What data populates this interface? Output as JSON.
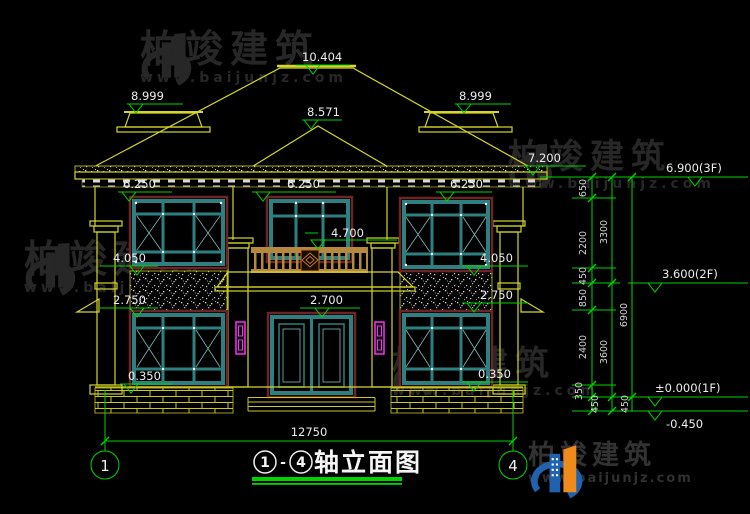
{
  "title_block": {
    "axis_from": "1",
    "separator": "-",
    "axis_to": "4",
    "name": "轴立面图"
  },
  "axis_bubbles": {
    "left": "1",
    "right": "4"
  },
  "overall_dim": "12750",
  "markers": {
    "ridge": "10.404",
    "left_wing": "8.999",
    "right_wing": "8.999",
    "porch_ridge": "8.571",
    "eave": "7.200",
    "f3": "6.900(3F)",
    "eave_l": "6.250",
    "eave_c": "6.250",
    "eave_r": "6.250",
    "balcony": "4.700",
    "sill2_l": "4.050",
    "sill2_r": "4.050",
    "head1_l": "2.750",
    "head1_r": "2.750",
    "porch": "2.700",
    "sill1_l": "0.350",
    "sill1_r": "0.350",
    "f2": "3.600(2F)",
    "f1": "±0.000(1F)",
    "ground": "-0.450"
  },
  "chain": {
    "c650": "650",
    "c2200": "2200",
    "c450a": "450",
    "c850": "850",
    "c2400": "2400",
    "c350": "350",
    "c450b": "450",
    "c450c": "450",
    "c3300": "3300",
    "c3600": "3600",
    "c6900": "6900"
  },
  "watermark": {
    "brand": "柏竣建筑",
    "url": "www.baijunjz.com"
  },
  "logo": {
    "brand": "柏竣建筑",
    "url": "www.baijunjz.com"
  },
  "colors": {
    "line_yellow": "#d6d62a",
    "dim_green": "#00d400",
    "text_white": "#ededed",
    "window_teal": "#2e8080",
    "frame_maroon": "#6e2424",
    "rail_brown": "#b5883f",
    "downspout_magenta": "#ff2bff",
    "logo_blue": "#1f63b0",
    "logo_orange": "#f08a1d"
  }
}
